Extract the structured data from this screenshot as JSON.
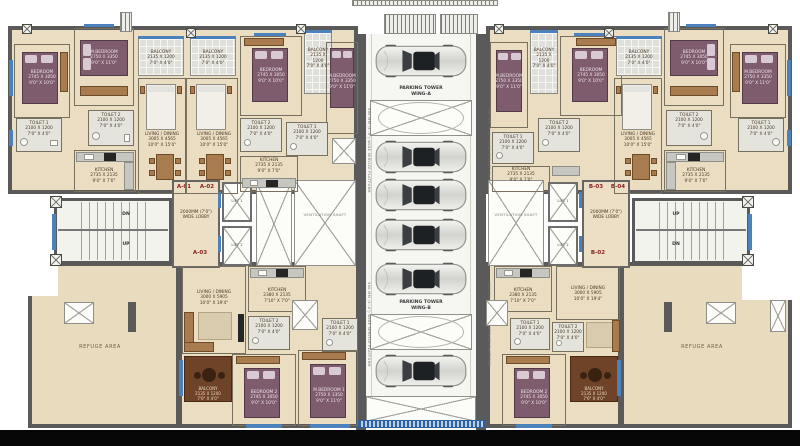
{
  "units": {
    "a01": "A-01",
    "a02": "A-02",
    "a03": "A-03",
    "b02": "B-02",
    "b03": "B-03",
    "b04": "B-04"
  },
  "parking": {
    "wing_a": "PARKING TOWER\nWING-A",
    "wing_b": "PARKING TOWER\nWING-B",
    "service": "900 MM (3'-0\") WIDE SERVICE PLATFORM"
  },
  "core": {
    "lift1": "LIFT 1",
    "lift2": "LIFT 2",
    "lobby": "2000MM (7'0\")\nWIDE LOBBY",
    "vent": "VENTILATION SHAFT",
    "up": "UP",
    "dn": "DN",
    "refuge": "REFUGE AREA"
  },
  "rooms": {
    "bedroom": "BEDROOM\n2745 X 3050\n9'0\" X 10'0\"",
    "mbedroom": "M.BEDROOM\n2750 X 3350\n9'0\" X 11'0\"",
    "bedroom2": "BEDROOM 2\n2745 X 3050\n9'0\" X 10'0\"",
    "mbedroom1": "M.BEDROOM 1\n2750 X 3350\n9'0\" X 11'0\"",
    "toilet1": "TOILET 1\n2100 X 1200\n7'0\" X 4'0\"",
    "toilet2": "TOILET 2\n2100 X 1200\n7'0\" X 4'0\"",
    "kitchen": "KITCHEN\n2735 X 2135\n9'0\" X 7'0\"",
    "kitchen_b": "KITCHEN\n2380 X 2135\n7'10\" X 7'0\"",
    "living_top": "LIVING / DINING\n3005 X 4565\n10'0\" X 15'0\"",
    "living_bottom": "LIVING / DINING\n3000 X 5905\n10'0\" X 19'4\"",
    "balcony": "BALCONY\n2135 X 1200\n7'0\" X 4'0\""
  },
  "colors": {
    "wall": "#5a5a5a",
    "floor": "#eaddc2",
    "refuge": "#e9dbbe",
    "bed": "#7e5b6d",
    "wood": "#a87c4f",
    "window_blue": "#4c82bc",
    "unit_label": "#8a2020"
  }
}
